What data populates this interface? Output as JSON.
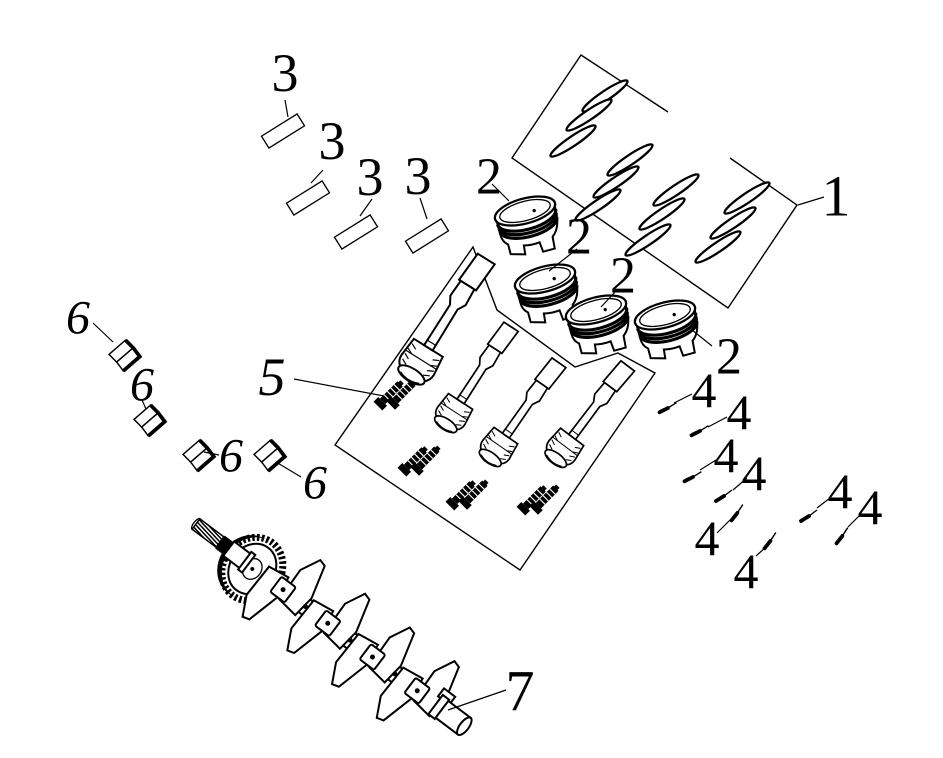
{
  "diagram": {
    "description": "exploded parts diagram of engine bottom end",
    "style": {
      "background": "#ffffff",
      "line_color": "#000000"
    },
    "callouts": {
      "ring_set": {
        "label": "1",
        "part": "piston-ring-set"
      },
      "piston": {
        "label": "2",
        "part": "piston"
      },
      "piston_pin": {
        "label": "3",
        "part": "piston-pin"
      },
      "circlip": {
        "label": "4",
        "part": "piston-pin-circlip"
      },
      "rod_assembly": {
        "label": "5",
        "part": "connecting-rod-and-bolts"
      },
      "bearing_shell": {
        "label": "6",
        "part": "rod-bearing-shell"
      },
      "crankshaft": {
        "label": "7",
        "part": "crankshaft"
      }
    }
  }
}
